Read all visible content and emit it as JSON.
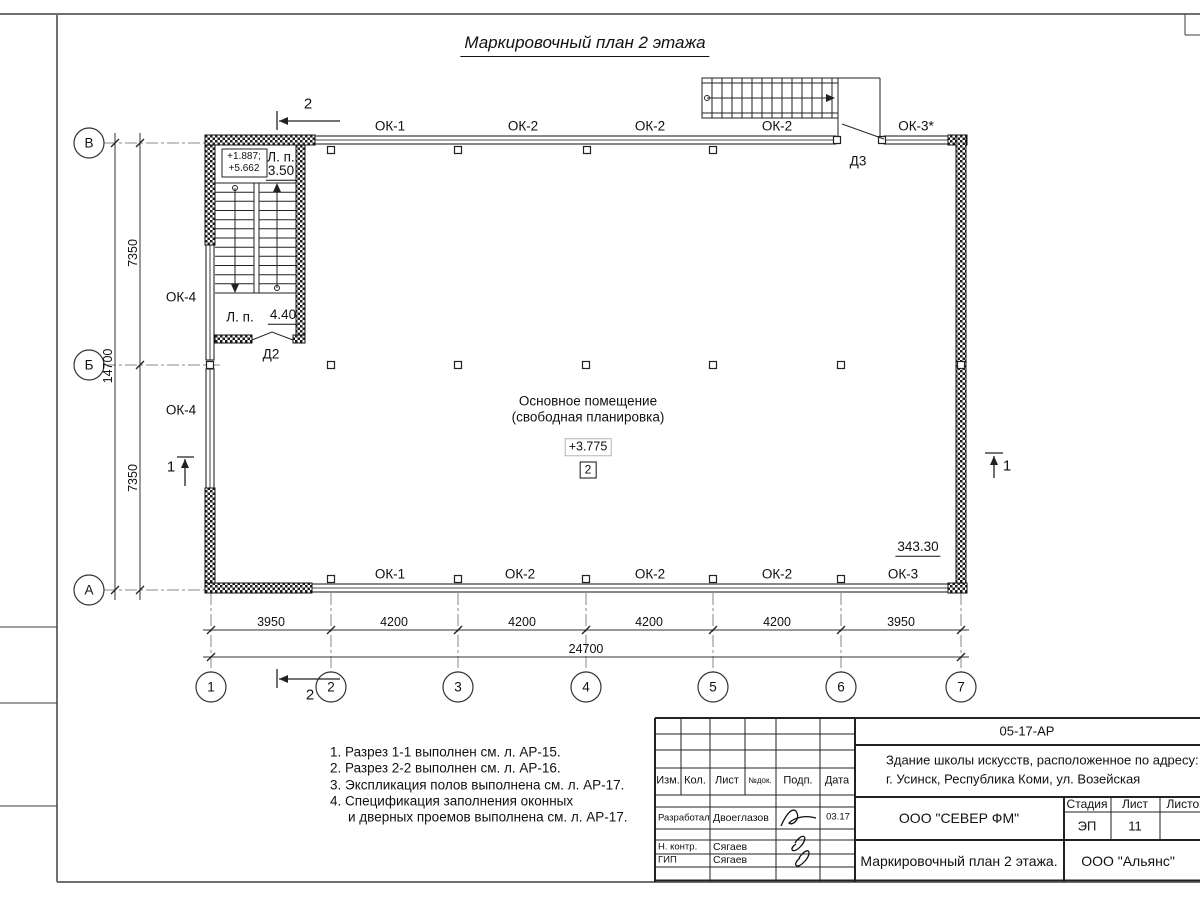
{
  "sheet": {
    "title": "Маркировочный план 2 этажа"
  },
  "plan": {
    "room": {
      "name1": "Основное помещение",
      "name2": "(свободная планировка)",
      "level": "+3.775",
      "number": "2"
    },
    "labels": [
      {
        "t": "ОК-1",
        "x": 390,
        "y": 126,
        "n": "window-mark"
      },
      {
        "t": "ОК-2",
        "x": 523,
        "y": 126,
        "n": "window-mark"
      },
      {
        "t": "ОК-2",
        "x": 650,
        "y": 126,
        "n": "window-mark"
      },
      {
        "t": "ОК-2",
        "x": 777,
        "y": 126,
        "n": "window-mark"
      },
      {
        "t": "ОК-3*",
        "x": 916,
        "y": 126,
        "n": "window-mark"
      },
      {
        "t": "Д3",
        "x": 858,
        "y": 161,
        "n": "door-mark"
      },
      {
        "t": "ОК-4",
        "x": 181,
        "y": 297,
        "n": "window-mark"
      },
      {
        "t": "ОК-4",
        "x": 181,
        "y": 410,
        "n": "window-mark"
      },
      {
        "t": "Л. п.",
        "x": 281,
        "y": 157,
        "n": "landing-label"
      },
      {
        "t": "3.50",
        "x": 281,
        "y": 172,
        "c": "c-u",
        "n": "landing-area"
      },
      {
        "t": "+1.887;",
        "x": 244,
        "y": 157,
        "c": "c-sm",
        "n": "stair-level"
      },
      {
        "t": "+5.662",
        "x": 244,
        "y": 169,
        "c": "c-sm",
        "n": "stair-level"
      },
      {
        "t": "Л. п.",
        "x": 240,
        "y": 317,
        "n": "landing-label"
      },
      {
        "t": "4.40",
        "x": 283,
        "y": 316,
        "c": "c-u",
        "n": "landing-area"
      },
      {
        "t": "Д2",
        "x": 271,
        "y": 354,
        "n": "door-mark"
      },
      {
        "t": "343.30",
        "x": 918,
        "y": 548,
        "c": "c-u",
        "n": "room-area"
      },
      {
        "t": "ОК-1",
        "x": 390,
        "y": 574,
        "n": "window-mark"
      },
      {
        "t": "ОК-2",
        "x": 520,
        "y": 574,
        "n": "window-mark"
      },
      {
        "t": "ОК-2",
        "x": 650,
        "y": 574,
        "n": "window-mark"
      },
      {
        "t": "ОК-2",
        "x": 777,
        "y": 574,
        "n": "window-mark"
      },
      {
        "t": "ОК-3",
        "x": 903,
        "y": 574,
        "n": "window-mark"
      },
      {
        "t": "3950",
        "x": 271,
        "y": 622,
        "c": "c-dim",
        "n": "dimension"
      },
      {
        "t": "4200",
        "x": 394,
        "y": 622,
        "c": "c-dim",
        "n": "dimension"
      },
      {
        "t": "4200",
        "x": 522,
        "y": 622,
        "c": "c-dim",
        "n": "dimension"
      },
      {
        "t": "4200",
        "x": 649,
        "y": 622,
        "c": "c-dim",
        "n": "dimension"
      },
      {
        "t": "4200",
        "x": 777,
        "y": 622,
        "c": "c-dim",
        "n": "dimension"
      },
      {
        "t": "3950",
        "x": 901,
        "y": 622,
        "c": "c-dim",
        "n": "dimension"
      },
      {
        "t": "24700",
        "x": 586,
        "y": 649,
        "c": "c-dim",
        "n": "dimension-total"
      },
      {
        "t": "7350",
        "x": 133,
        "y": 253,
        "c": "c-dim c-rot",
        "n": "dimension"
      },
      {
        "t": "7350",
        "x": 133,
        "y": 478,
        "c": "c-dim c-rot",
        "n": "dimension"
      },
      {
        "t": "14700",
        "x": 108,
        "y": 366,
        "c": "c-dim c-rot",
        "n": "dimension-total"
      },
      {
        "t": "2",
        "x": 308,
        "y": 104,
        "c": "c-sec",
        "n": "section-mark"
      },
      {
        "t": "2",
        "x": 310,
        "y": 695,
        "c": "c-sec",
        "n": "section-mark"
      },
      {
        "t": "1",
        "x": 171,
        "y": 467,
        "c": "c-sec",
        "n": "section-mark"
      },
      {
        "t": "1",
        "x": 1007,
        "y": 466,
        "c": "c-sec",
        "n": "section-mark"
      },
      {
        "t": "1",
        "x": 211,
        "y": 687,
        "c": "c-bub",
        "n": "grid-bubble"
      },
      {
        "t": "2",
        "x": 331,
        "y": 687,
        "c": "c-bub",
        "n": "grid-bubble"
      },
      {
        "t": "3",
        "x": 458,
        "y": 687,
        "c": "c-bub",
        "n": "grid-bubble"
      },
      {
        "t": "4",
        "x": 586,
        "y": 687,
        "c": "c-bub",
        "n": "grid-bubble"
      },
      {
        "t": "5",
        "x": 713,
        "y": 687,
        "c": "c-bub",
        "n": "grid-bubble"
      },
      {
        "t": "6",
        "x": 841,
        "y": 687,
        "c": "c-bub",
        "n": "grid-bubble"
      },
      {
        "t": "7",
        "x": 961,
        "y": 687,
        "c": "c-bub",
        "n": "grid-bubble"
      },
      {
        "t": "В",
        "x": 89,
        "y": 143,
        "c": "c-bub",
        "n": "grid-bubble"
      },
      {
        "t": "Б",
        "x": 89,
        "y": 365,
        "c": "c-bub",
        "n": "grid-bubble"
      },
      {
        "t": "А",
        "x": 89,
        "y": 590,
        "c": "c-bub",
        "n": "grid-bubble"
      },
      {
        "t": "1. Разрез 1-1 выполнен см. л. АР-15.",
        "x": 330,
        "y": 752,
        "c": "c-note",
        "n": "note-line"
      },
      {
        "t": "2. Разрез 2-2 выполнен см. л. АР-16.",
        "x": 330,
        "y": 768,
        "c": "c-note",
        "n": "note-line"
      },
      {
        "t": "3. Экспликация полов выполнена см. л. АР-17.",
        "x": 330,
        "y": 785,
        "c": "c-note",
        "n": "note-line"
      },
      {
        "t": "4. Спецификация заполнения оконных",
        "x": 330,
        "y": 801,
        "c": "c-note",
        "n": "note-line"
      },
      {
        "t": "и дверных проемов выполнена см. л. АР-17.",
        "x": 348,
        "y": 817,
        "c": "c-note",
        "n": "note-line"
      }
    ]
  },
  "titleblock": {
    "code": "05-17-АР",
    "object_line1": "Здание школы искусств, расположенное по адресу:",
    "object_line2": "г. Усинск, Республика Коми, ул. Возейская",
    "cols": [
      "Изм.",
      "Кол.",
      "Лист",
      "№док.",
      "Подп.",
      "Дата"
    ],
    "rows": [
      {
        "role": "Разработал",
        "name": "Двоеглазов",
        "date": "03.17"
      },
      {
        "role": "Н. контр.",
        "name": "Сягаев"
      },
      {
        "role": "ГИП",
        "name": "Сягаев"
      }
    ],
    "stage_label": "Стадия",
    "sheet_label": "Лист",
    "sheets_label": "Листов",
    "stage": "ЭП",
    "sheet_no": "11",
    "org1": "ООО \"СЕВЕР ФМ\"",
    "drawing_title": "Маркировочный план 2 этажа.",
    "org2": "ООО \"Альянс\""
  }
}
